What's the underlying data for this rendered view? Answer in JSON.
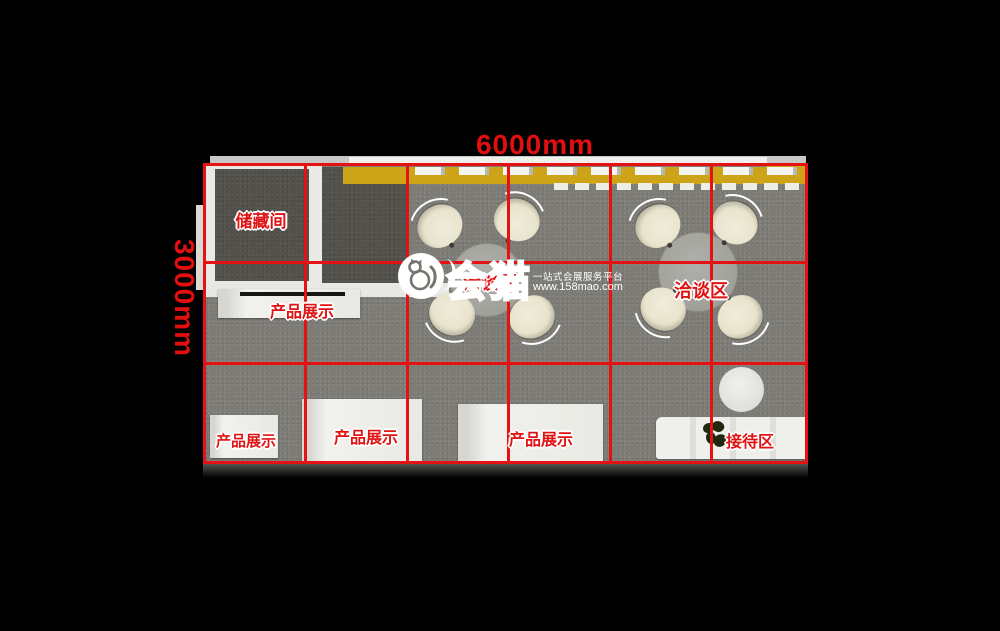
{
  "dimensions": {
    "width_label": "6000mm",
    "height_label": "3000mm"
  },
  "areas": {
    "storage": "储藏间",
    "product_display": [
      "产品展示",
      "产品展示",
      "产品展示",
      "产品展示"
    ],
    "negotiation_left": "洽谈区",
    "negotiation_right": "洽谈区",
    "reception": "接待区"
  },
  "watermark": {
    "brand": "会猫",
    "tagline": "一站式会展服务平台",
    "url": "www.158mao.com"
  },
  "colors": {
    "grid_red": "#e41212",
    "label_red": "#e01212",
    "wall_yellow": "#cda417",
    "floor_gray": "#7e7c76",
    "storage_dark_gray": "#53514b",
    "chair_cream": "#e8e4cf",
    "background": "#000000"
  }
}
